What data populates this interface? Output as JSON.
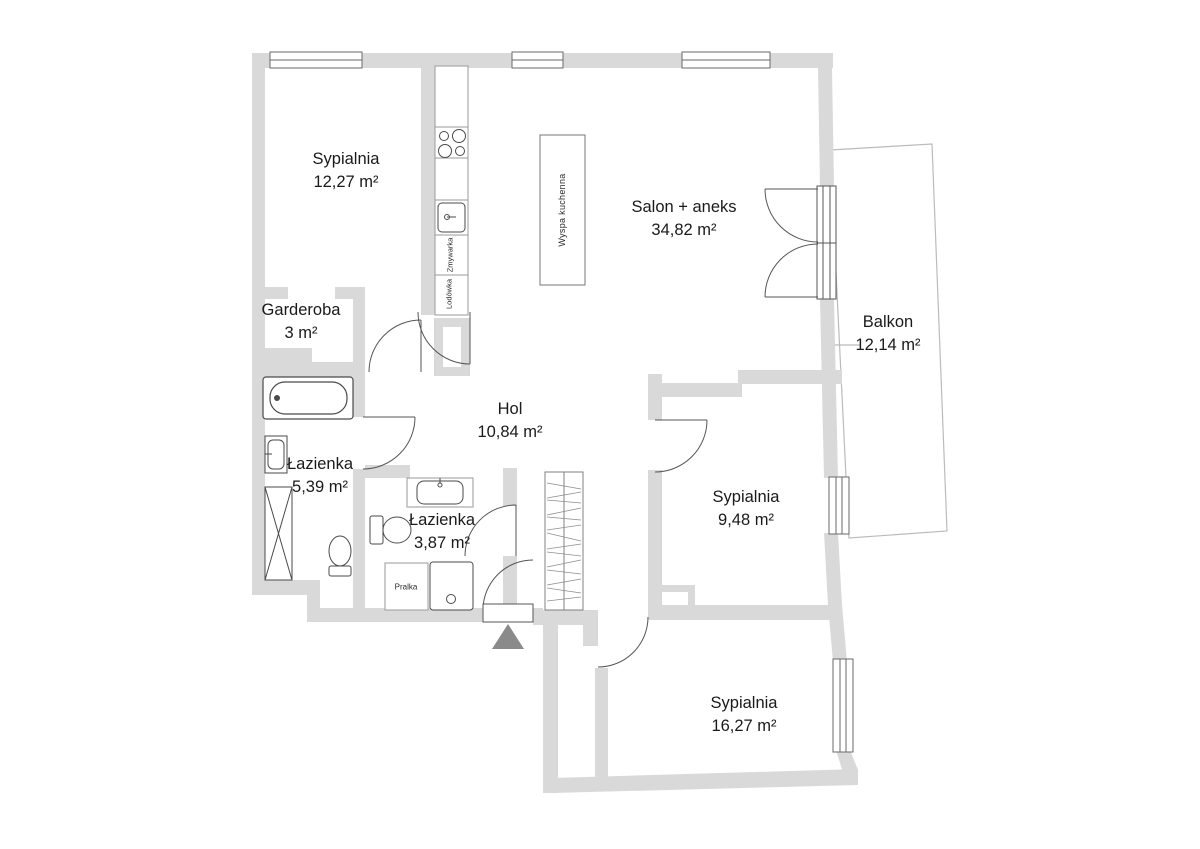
{
  "floorplan": {
    "rooms": [
      {
        "name": "Sypialnia",
        "area": "12,27 m²"
      },
      {
        "name": "Garderoba",
        "area": "3 m²"
      },
      {
        "name": "Łazienka",
        "area": "5,39 m²"
      },
      {
        "name": "Łazienka",
        "area": "3,87 m²"
      },
      {
        "name": "Hol",
        "area": "10,84 m²"
      },
      {
        "name": "Salon + aneks",
        "area": "34,82 m²"
      },
      {
        "name": "Balkon",
        "area": "12,14 m²"
      },
      {
        "name": "Sypialnia",
        "area": "9,48 m²"
      },
      {
        "name": "Sypialnia",
        "area": "16,27 m²"
      }
    ],
    "fixtures": {
      "kitchen_island": "Wyspa kuchenna",
      "dishwasher": "Zmywarka",
      "fridge": "Lodówka",
      "washing_machine": "Pralka"
    },
    "colors": {
      "wall": "#d9d9d9",
      "fixture_outline": "#4a4a4a",
      "cabinet_outline": "#9a9a9a",
      "balcony_outline": "#bbbbbb",
      "entrance_marker": "#8a8a8a",
      "text": "#1a1a1a"
    }
  }
}
